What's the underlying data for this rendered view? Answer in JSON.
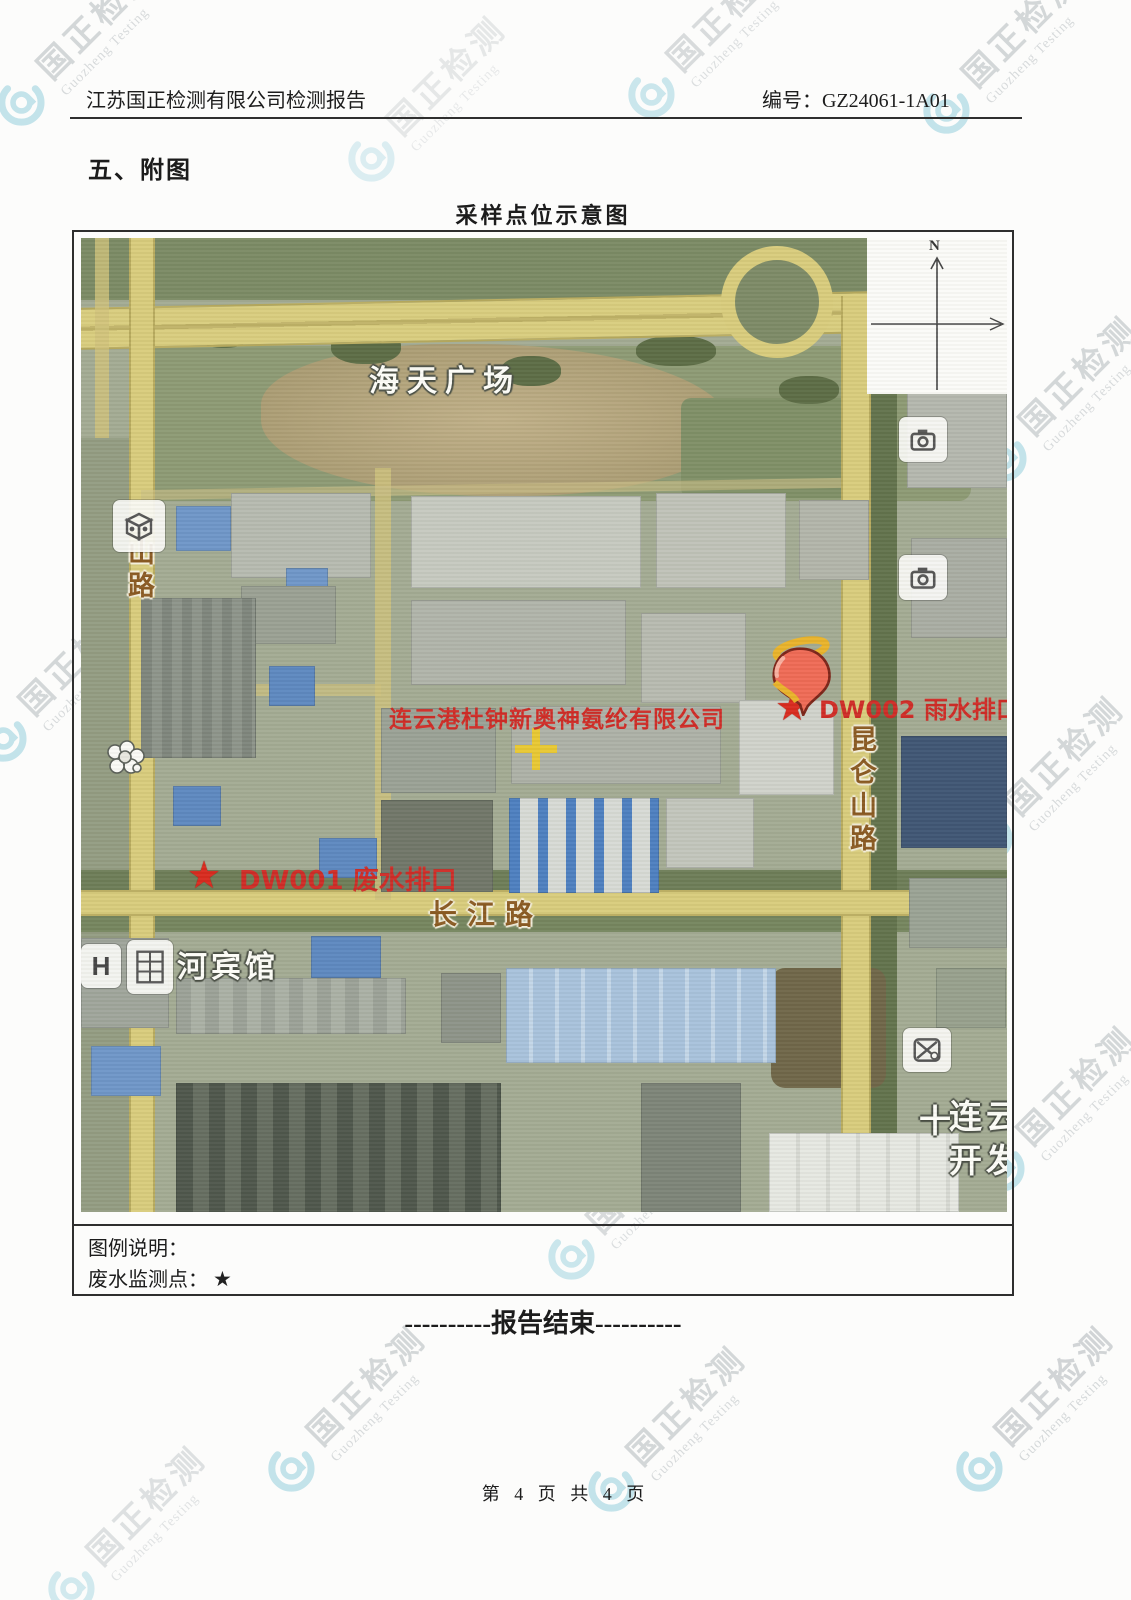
{
  "header": {
    "title": "江苏国正检测有限公司检测报告",
    "report_no": "编号：GZ24061-1A01"
  },
  "section": {
    "title": "五、附图"
  },
  "figure": {
    "title": "采样点位示意图"
  },
  "map": {
    "plaza_label": "海天广场",
    "company_label": "连云港杜钟新奥神氨纶有限公司",
    "road_left": "山路",
    "road_right": "昆仑山路",
    "road_bottom": "长江路",
    "hotel_label": "河宾馆",
    "hotel_icon_letter": "H",
    "district_line1": "连云",
    "district_line2": "开发",
    "district_cross": "十",
    "compass_n": "N",
    "marker1_symbol": "★",
    "marker1_label": "DW001 废水排口",
    "marker2_symbol": "★",
    "marker2_label": "DW002 雨水排口"
  },
  "legend": {
    "heading": "图例说明：",
    "item": "废水监测点：",
    "symbol": "★"
  },
  "end_text": "----------报告结束----------",
  "footer": {
    "page_info": "第 4 页 共 4 页"
  },
  "watermark": {
    "cn": "国正检测",
    "en": "Guozheng Testing"
  },
  "colors": {
    "marker_red": "#cf2b26",
    "road_label_brown": "#8a5a22",
    "watermark_cyan": "#b5dde6",
    "road_yellow": "#d8cc7c"
  }
}
